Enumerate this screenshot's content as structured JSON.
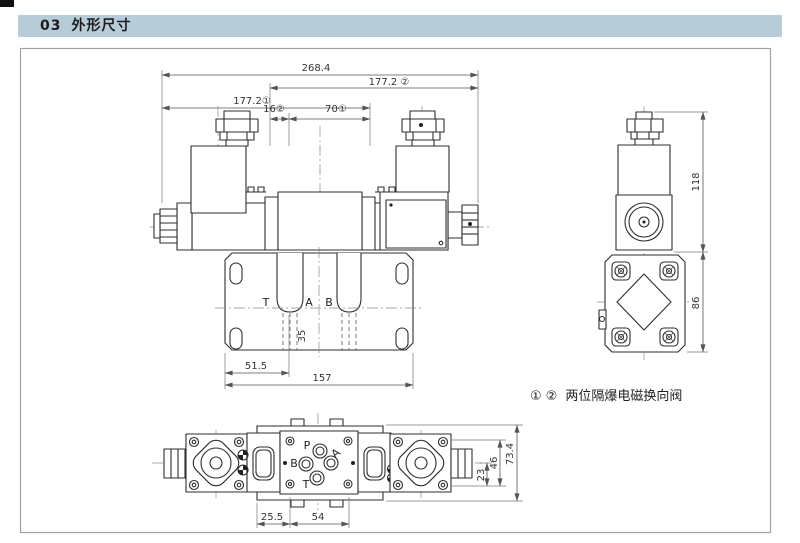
{
  "header": {
    "section": "03",
    "title": "外形尺寸"
  },
  "drawing": {
    "front_view": {
      "dim_overall": "268.4",
      "dim_width_right": "177.2 ②",
      "dim_width_left": "177.2①",
      "dim_16": "16②",
      "dim_70": "70①",
      "port_t": "T",
      "port_a": "A",
      "port_b": "B",
      "dim_35": "35",
      "dim_51_5": "51.5",
      "dim_157": "157"
    },
    "side_view": {
      "dim_118": "118",
      "dim_86": "86"
    },
    "caption": {
      "mark_1": "①",
      "mark_2": "②",
      "label": "两位隔爆电磁换向阀"
    },
    "bottom_view": {
      "port_p": "P",
      "port_a": "A",
      "port_b": "B",
      "port_t": "T",
      "dim_25_5": "25.5",
      "dim_54": "54",
      "dim_23": "23",
      "dim_46": "46",
      "dim_73_4": "73.4"
    }
  }
}
